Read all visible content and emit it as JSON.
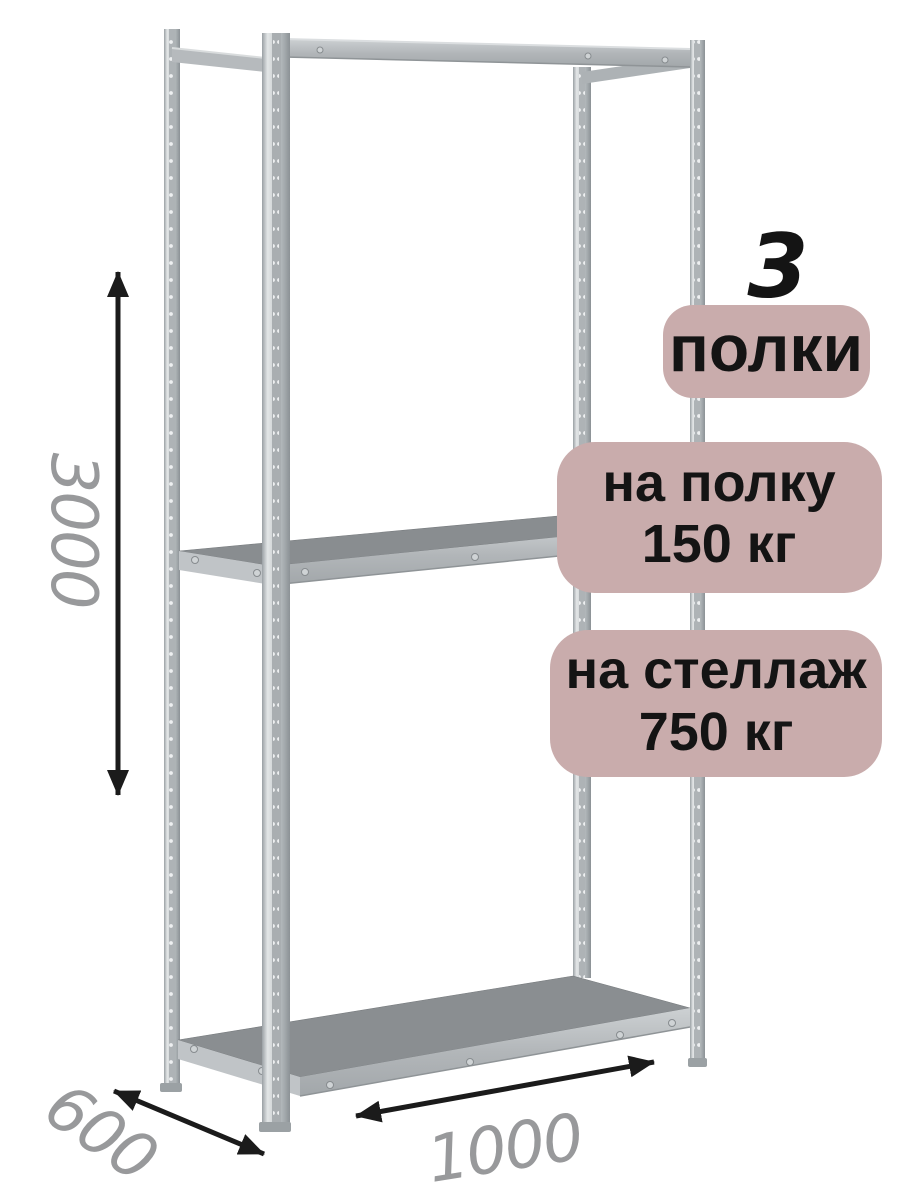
{
  "diagram": {
    "dimensions": {
      "height": "3000",
      "depth": "600",
      "width": "1000"
    },
    "badges": {
      "shelf_count_number": "3",
      "shelf_count_label": "полки",
      "shelf_load_line1": "на полку",
      "shelf_load_line2": "150 кг",
      "rack_load_line1": "на стеллаж",
      "rack_load_line2": "750 кг"
    },
    "colors": {
      "badge_bg": "#c9acac",
      "badge_text": "#141414",
      "dimension_text": "#98999b",
      "arrow": "#1b1b1b",
      "shelf_top": "#8a8e91",
      "metal_light": "#c6cacc",
      "background": "#ffffff"
    }
  }
}
